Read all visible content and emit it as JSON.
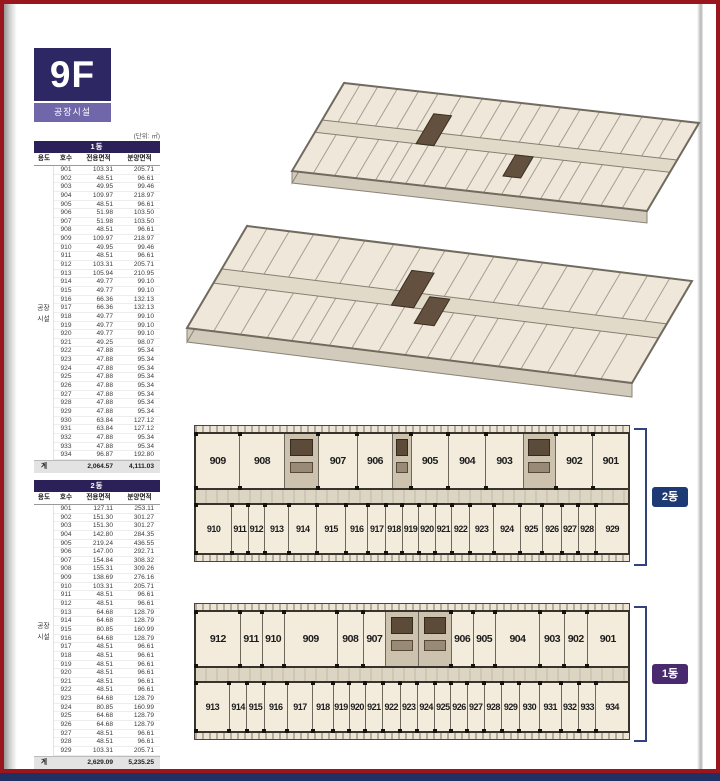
{
  "page": {
    "floor_label": "9F",
    "floor_sublabel": "공장시설",
    "unit_note": "(단위: ㎡)"
  },
  "colors": {
    "frame_red": "#9b151c",
    "bottom_bar_navy": "#1f3063",
    "badge_navy": "#2d2864",
    "badge_sub_purple": "#6f67aa",
    "table_title_navy": "#2b2158",
    "badge_2dong": "#1d3a74",
    "badge_1dong": "#4a2a6e"
  },
  "tables": {
    "columns": [
      "용도",
      "호수",
      "전용면적",
      "분양면적"
    ],
    "use_label_lines": [
      "공장",
      "시설"
    ],
    "total_label": "계",
    "t1": {
      "title": "1동",
      "rows": [
        {
          "ho": "901",
          "exc": "103.31",
          "sale": "205.71"
        },
        {
          "ho": "902",
          "exc": "48.51",
          "sale": "96.61"
        },
        {
          "ho": "903",
          "exc": "49.95",
          "sale": "99.46"
        },
        {
          "ho": "904",
          "exc": "109.97",
          "sale": "218.97"
        },
        {
          "ho": "905",
          "exc": "48.51",
          "sale": "96.61"
        },
        {
          "ho": "906",
          "exc": "51.98",
          "sale": "103.50"
        },
        {
          "ho": "907",
          "exc": "51.98",
          "sale": "103.50"
        },
        {
          "ho": "908",
          "exc": "48.51",
          "sale": "96.61"
        },
        {
          "ho": "909",
          "exc": "109.97",
          "sale": "218.97"
        },
        {
          "ho": "910",
          "exc": "49.95",
          "sale": "99.46"
        },
        {
          "ho": "911",
          "exc": "48.51",
          "sale": "96.61"
        },
        {
          "ho": "912",
          "exc": "103.31",
          "sale": "205.71"
        },
        {
          "ho": "913",
          "exc": "105.94",
          "sale": "210.95"
        },
        {
          "ho": "914",
          "exc": "49.77",
          "sale": "99.10"
        },
        {
          "ho": "915",
          "exc": "49.77",
          "sale": "99.10"
        },
        {
          "ho": "916",
          "exc": "66.36",
          "sale": "132.13"
        },
        {
          "ho": "917",
          "exc": "66.36",
          "sale": "132.13"
        },
        {
          "ho": "918",
          "exc": "49.77",
          "sale": "99.10"
        },
        {
          "ho": "919",
          "exc": "49.77",
          "sale": "99.10"
        },
        {
          "ho": "920",
          "exc": "49.77",
          "sale": "99.10"
        },
        {
          "ho": "921",
          "exc": "49.25",
          "sale": "98.07"
        },
        {
          "ho": "922",
          "exc": "47.88",
          "sale": "95.34"
        },
        {
          "ho": "923",
          "exc": "47.88",
          "sale": "95.34"
        },
        {
          "ho": "924",
          "exc": "47.88",
          "sale": "95.34"
        },
        {
          "ho": "925",
          "exc": "47.88",
          "sale": "95.34"
        },
        {
          "ho": "926",
          "exc": "47.88",
          "sale": "95.34"
        },
        {
          "ho": "927",
          "exc": "47.88",
          "sale": "95.34"
        },
        {
          "ho": "928",
          "exc": "47.88",
          "sale": "95.34"
        },
        {
          "ho": "929",
          "exc": "47.88",
          "sale": "95.34"
        },
        {
          "ho": "930",
          "exc": "63.84",
          "sale": "127.12"
        },
        {
          "ho": "931",
          "exc": "63.84",
          "sale": "127.12"
        },
        {
          "ho": "932",
          "exc": "47.88",
          "sale": "95.34"
        },
        {
          "ho": "933",
          "exc": "47.88",
          "sale": "95.34"
        },
        {
          "ho": "934",
          "exc": "96.87",
          "sale": "192.80"
        }
      ],
      "total_exc": "2,064.57",
      "total_sale": "4,111.03"
    },
    "t2": {
      "title": "2동",
      "rows": [
        {
          "ho": "901",
          "exc": "127.11",
          "sale": "253.11"
        },
        {
          "ho": "902",
          "exc": "151.30",
          "sale": "301.27"
        },
        {
          "ho": "903",
          "exc": "151.30",
          "sale": "301.27"
        },
        {
          "ho": "904",
          "exc": "142.80",
          "sale": "284.35"
        },
        {
          "ho": "905",
          "exc": "219.24",
          "sale": "436.55"
        },
        {
          "ho": "906",
          "exc": "147.00",
          "sale": "292.71"
        },
        {
          "ho": "907",
          "exc": "154.84",
          "sale": "308.32"
        },
        {
          "ho": "908",
          "exc": "155.31",
          "sale": "309.26"
        },
        {
          "ho": "909",
          "exc": "138.69",
          "sale": "276.16"
        },
        {
          "ho": "910",
          "exc": "103.31",
          "sale": "205.71"
        },
        {
          "ho": "911",
          "exc": "48.51",
          "sale": "96.61"
        },
        {
          "ho": "912",
          "exc": "48.51",
          "sale": "96.61"
        },
        {
          "ho": "913",
          "exc": "64.68",
          "sale": "128.79"
        },
        {
          "ho": "914",
          "exc": "64.68",
          "sale": "128.79"
        },
        {
          "ho": "915",
          "exc": "80.85",
          "sale": "160.99"
        },
        {
          "ho": "916",
          "exc": "64.68",
          "sale": "128.79"
        },
        {
          "ho": "917",
          "exc": "48.51",
          "sale": "96.61"
        },
        {
          "ho": "918",
          "exc": "48.51",
          "sale": "96.61"
        },
        {
          "ho": "919",
          "exc": "48.51",
          "sale": "96.61"
        },
        {
          "ho": "920",
          "exc": "48.51",
          "sale": "96.61"
        },
        {
          "ho": "921",
          "exc": "48.51",
          "sale": "96.61"
        },
        {
          "ho": "922",
          "exc": "48.51",
          "sale": "96.61"
        },
        {
          "ho": "923",
          "exc": "64.68",
          "sale": "128.79"
        },
        {
          "ho": "924",
          "exc": "80.85",
          "sale": "160.99"
        },
        {
          "ho": "925",
          "exc": "64.68",
          "sale": "128.79"
        },
        {
          "ho": "926",
          "exc": "64.68",
          "sale": "128.79"
        },
        {
          "ho": "927",
          "exc": "48.51",
          "sale": "96.61"
        },
        {
          "ho": "928",
          "exc": "48.51",
          "sale": "96.61"
        },
        {
          "ho": "929",
          "exc": "103.31",
          "sale": "205.71"
        }
      ],
      "total_exc": "2,629.09",
      "total_sale": "5,235.25"
    }
  },
  "plans": {
    "p2": {
      "badge": "2동",
      "top": [
        {
          "no": "909",
          "w": 55
        },
        {
          "no": "908",
          "w": 55
        },
        {
          "cls": "core",
          "w": 42
        },
        {
          "no": "907",
          "w": 48
        },
        {
          "no": "906",
          "w": 44
        },
        {
          "cls": "core",
          "w": 22
        },
        {
          "no": "905",
          "w": 46
        },
        {
          "no": "904",
          "w": 46
        },
        {
          "no": "903",
          "w": 46
        },
        {
          "cls": "core",
          "w": 40
        },
        {
          "no": "902",
          "w": 46
        },
        {
          "no": "901",
          "w": 44
        }
      ],
      "bottom": [
        {
          "no": "910",
          "w": 50
        },
        {
          "no": "911",
          "w": 22
        },
        {
          "no": "912",
          "w": 22
        },
        {
          "no": "913",
          "w": 33
        },
        {
          "no": "914",
          "w": 38
        },
        {
          "no": "915",
          "w": 40
        },
        {
          "no": "916",
          "w": 30
        },
        {
          "no": "917",
          "w": 24
        },
        {
          "no": "918",
          "w": 22
        },
        {
          "no": "919",
          "w": 22
        },
        {
          "no": "920",
          "w": 22
        },
        {
          "no": "921",
          "w": 22
        },
        {
          "no": "922",
          "w": 24
        },
        {
          "no": "923",
          "w": 33
        },
        {
          "no": "924",
          "w": 36
        },
        {
          "no": "925",
          "w": 30
        },
        {
          "no": "926",
          "w": 26
        },
        {
          "no": "927",
          "w": 22
        },
        {
          "no": "928",
          "w": 24
        },
        {
          "no": "929",
          "w": 45
        }
      ]
    },
    "p1": {
      "badge": "1동",
      "top": [
        {
          "no": "912",
          "w": 52
        },
        {
          "no": "911",
          "w": 25
        },
        {
          "no": "910",
          "w": 25
        },
        {
          "no": "909",
          "w": 62
        },
        {
          "no": "908",
          "w": 30
        },
        {
          "no": "907",
          "w": 25
        },
        {
          "cls": "core",
          "w": 38
        },
        {
          "cls": "core",
          "w": 38
        },
        {
          "no": "906",
          "w": 25
        },
        {
          "no": "905",
          "w": 25
        },
        {
          "no": "904",
          "w": 52
        },
        {
          "no": "903",
          "w": 28
        },
        {
          "no": "902",
          "w": 26
        },
        {
          "no": "901",
          "w": 48
        }
      ],
      "bottom": [
        {
          "no": "913",
          "w": 48
        },
        {
          "no": "914",
          "w": 24
        },
        {
          "no": "915",
          "w": 24
        },
        {
          "no": "916",
          "w": 32
        },
        {
          "no": "917",
          "w": 36
        },
        {
          "no": "918",
          "w": 28
        },
        {
          "no": "919",
          "w": 22
        },
        {
          "no": "920",
          "w": 22
        },
        {
          "no": "921",
          "w": 24
        },
        {
          "no": "922",
          "w": 24
        },
        {
          "no": "923",
          "w": 24
        },
        {
          "no": "924",
          "w": 24
        },
        {
          "no": "925",
          "w": 22
        },
        {
          "no": "926",
          "w": 22
        },
        {
          "no": "927",
          "w": 24
        },
        {
          "no": "928",
          "w": 24
        },
        {
          "no": "929",
          "w": 24
        },
        {
          "no": "930",
          "w": 28
        },
        {
          "no": "931",
          "w": 30
        },
        {
          "no": "932",
          "w": 24
        },
        {
          "no": "933",
          "w": 24
        },
        {
          "no": "934",
          "w": 46
        }
      ]
    }
  }
}
